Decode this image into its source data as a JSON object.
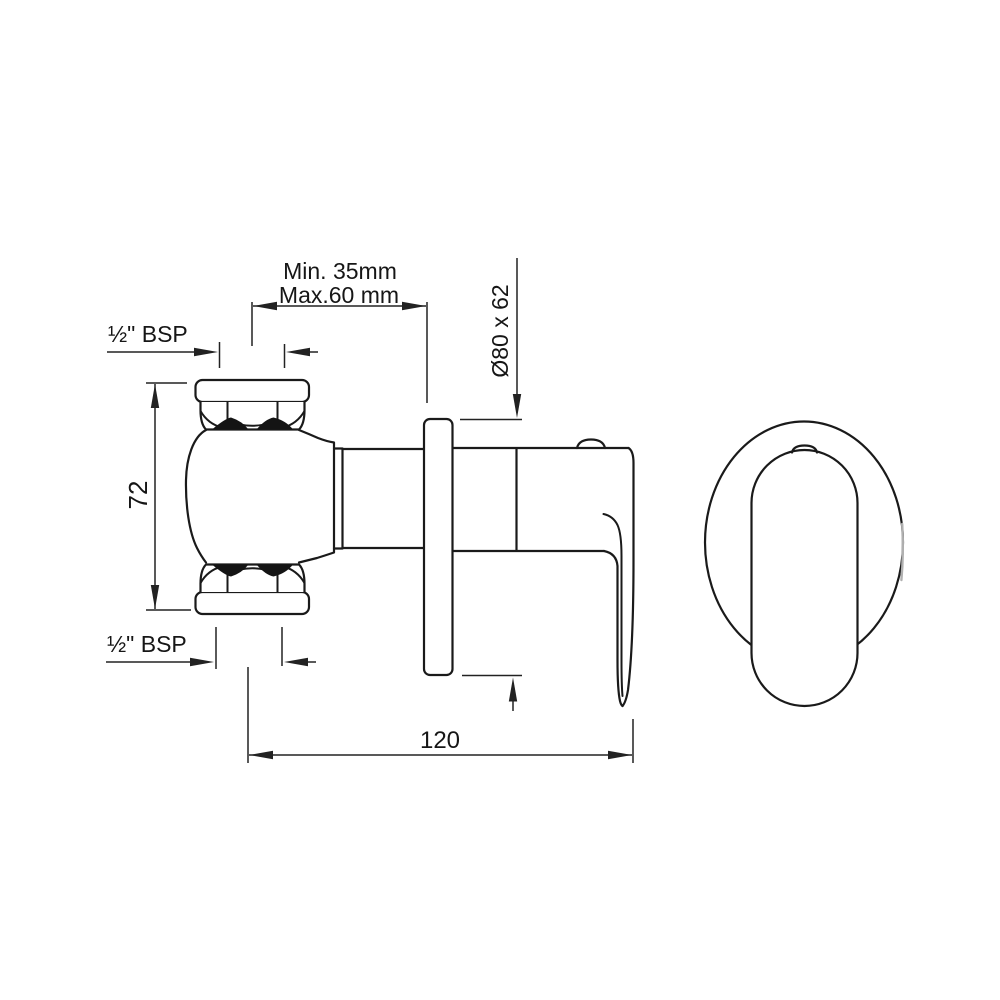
{
  "drawing_type": "technical-dimension-drawing",
  "views": {
    "side_view": "concealed-stop-valve-side-elevation",
    "front_view": "escutcheon-and-lever-front-elevation"
  },
  "dimensions": {
    "min_depth": "Min. 35mm",
    "max_depth": "Max.60 mm",
    "flange_size": "Ø80 x 62",
    "body_height": "72",
    "inlet_thread": "½\" BSP",
    "outlet_thread": "½\" BSP",
    "total_length": "120"
  },
  "colors": {
    "line": "#1a1a1a",
    "dimension_line": "#222222",
    "background": "#ffffff",
    "shadow_fill": "#141414",
    "highlight_gray": "#b0b0b0"
  }
}
